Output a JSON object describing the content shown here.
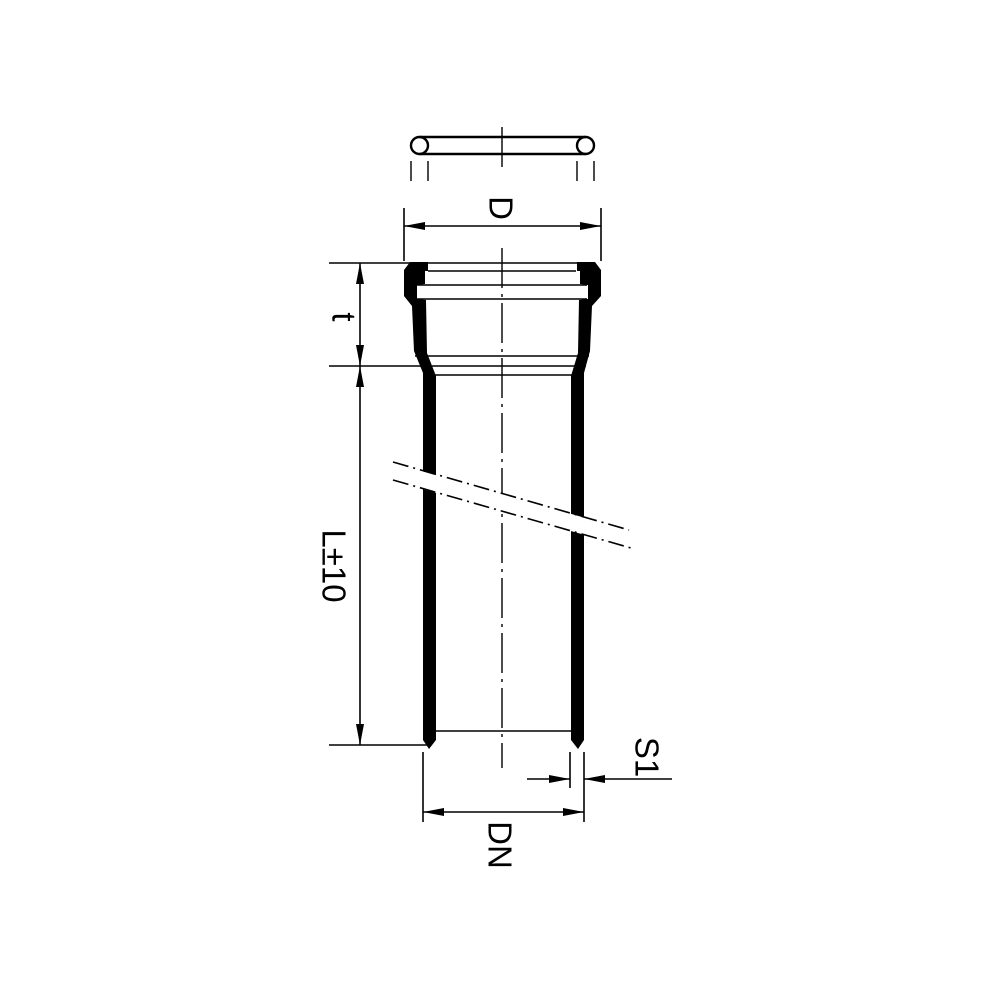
{
  "drawing": {
    "kind": "pipe-with-socket-dimensioned-drawing",
    "labels": {
      "D": "D",
      "t": "t",
      "L": "L±10",
      "S1": "S1",
      "DN": "DN"
    },
    "colors": {
      "line": "#000000",
      "background": "#ffffff"
    }
  }
}
